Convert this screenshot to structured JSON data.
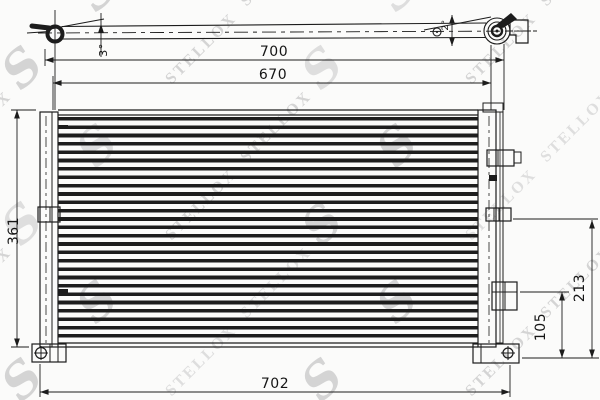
{
  "watermark": {
    "brand": "STELLOX",
    "logo_glyph": "S",
    "color": "#d4d4d4"
  },
  "colors": {
    "line": "#1c1c1c",
    "background": "#fbfbfa"
  },
  "dimensions": {
    "top_length": "700",
    "mid_length": "670",
    "bottom_length": "702",
    "left_height": "361",
    "right_height_small": "105",
    "right_height_large": "213",
    "angle_left": "3°",
    "angle_right": "2°"
  }
}
